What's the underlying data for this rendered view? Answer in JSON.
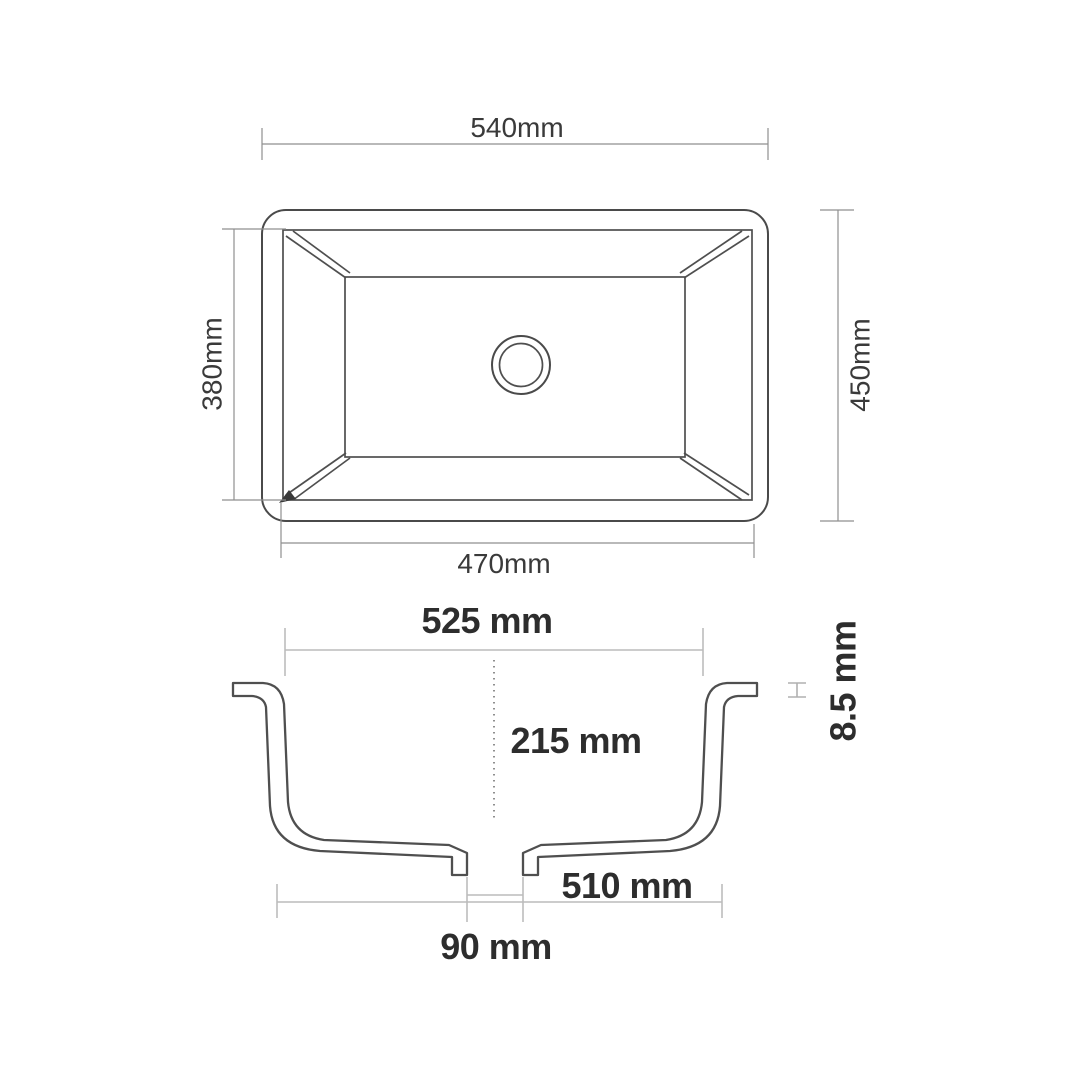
{
  "page": {
    "background": "#ffffff",
    "description": "Technical dimension drawing of a rectangular undermount sink with a plan view (top) and a cross-section view (bottom)"
  },
  "top_view": {
    "view_name": "plan-view",
    "dim_outer_width": "540mm",
    "dim_outer_height": "450mm",
    "dim_inner_height": "380mm",
    "dim_inner_width": "470mm"
  },
  "section_view": {
    "view_name": "cross-section-view",
    "dim_rim_opening_width": "525 mm",
    "dim_bowl_depth": "215 mm",
    "dim_rim_thickness": "8.5 mm",
    "dim_base_width": "510 mm",
    "dim_drain_opening": "90 mm"
  },
  "colors": {
    "outline": "#4a4a4a",
    "dimension_line_top_view": "#8f8f8f",
    "dimension_line_section_view": "#bcbcbc",
    "label_top_view": "#3a3a3a",
    "label_section_view": "#2d2d2d",
    "rim_thickness_mark": "#b0b0b0"
  }
}
